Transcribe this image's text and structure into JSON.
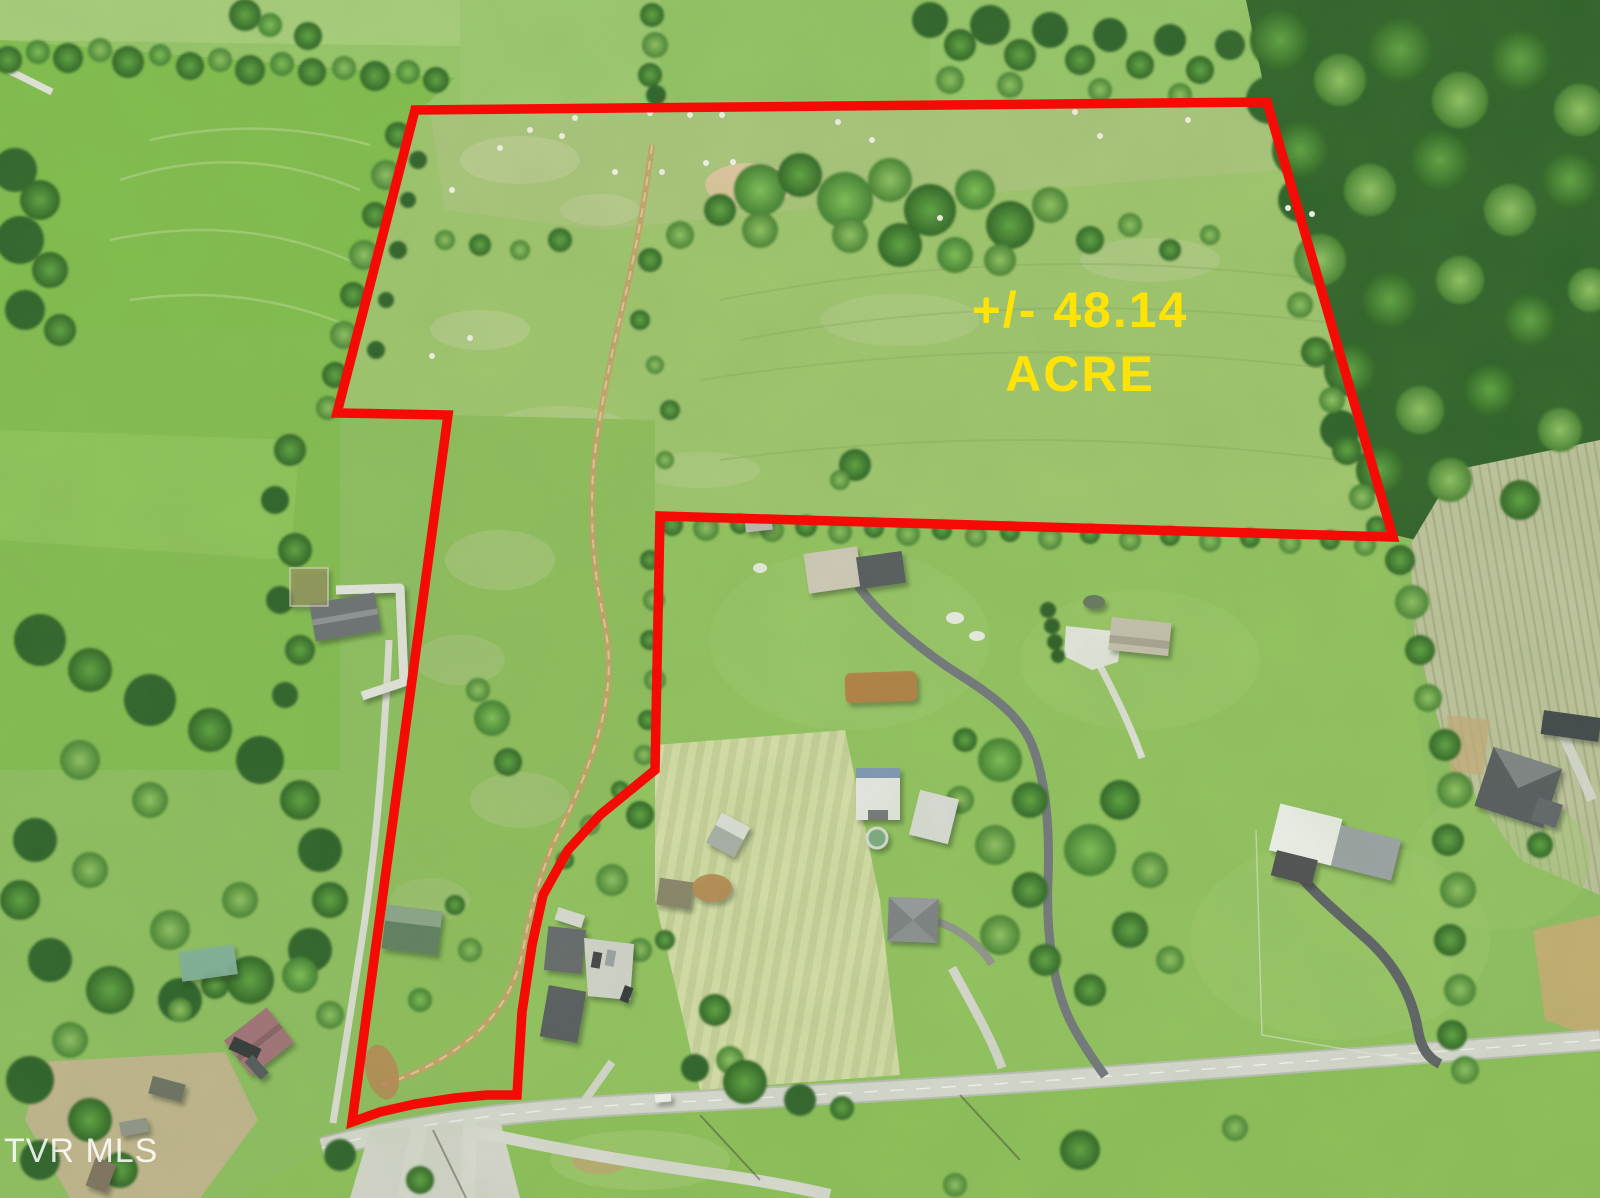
{
  "acreage_label": {
    "line1": "+/- 48.14",
    "line2": "ACRE",
    "color": "#FFE206"
  },
  "boundary": {
    "color": "#F50B06"
  },
  "watermark": {
    "text": "TVR MLS",
    "color": "#FFFFFF"
  }
}
